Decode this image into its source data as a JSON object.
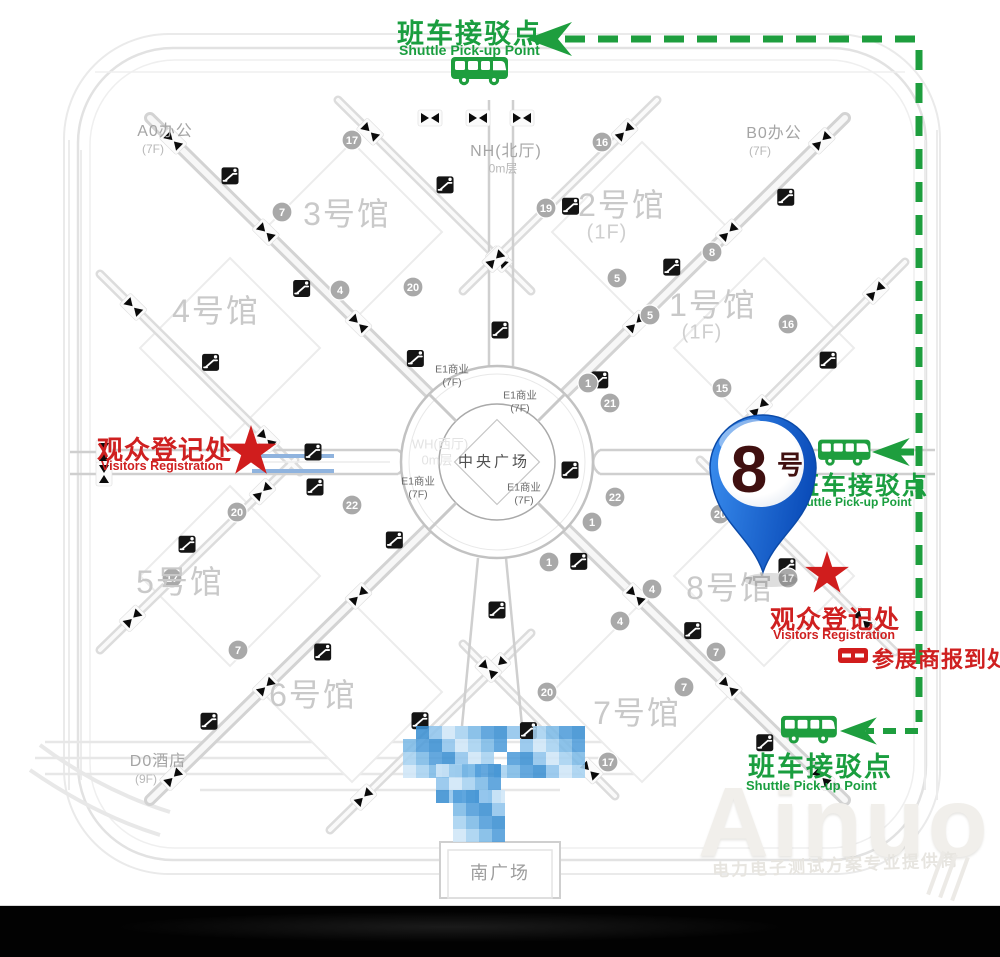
{
  "overlays": {
    "shuttle_top": {
      "cn": "班车接驳点",
      "en": "Shuttle Pick-up Point"
    },
    "shuttle_right": {
      "cn": "班车接驳点",
      "en": "Shuttle Pick-up Point"
    },
    "shuttle_bottom": {
      "cn": "班车接驳点",
      "en": "Shuttle Pick-up Point"
    },
    "visitors_left": {
      "cn": "观众登记处",
      "en": "Visitors Registration"
    },
    "visitors_right": {
      "cn": "观众登记处",
      "en": "Visitors Registration"
    },
    "exhibitor_checkin": {
      "label": "参展商报到处"
    },
    "pin": {
      "number": "8",
      "suffix": "号"
    }
  },
  "map": {
    "halls": [
      {
        "name": "3号馆",
        "floor": ""
      },
      {
        "name": "2号馆",
        "floor": "(1F)"
      },
      {
        "name": "4号馆",
        "floor": ""
      },
      {
        "name": "1号馆",
        "floor": "(1F)"
      },
      {
        "name": "5号馆",
        "floor": ""
      },
      {
        "name": "8号馆",
        "floor": ""
      },
      {
        "name": "6号馆",
        "floor": ""
      },
      {
        "name": "7号馆",
        "floor": ""
      }
    ],
    "buildings": {
      "a0": {
        "name": "A0办公",
        "floor": "(7F)"
      },
      "b0": {
        "name": "B0办公",
        "floor": "(7F)"
      },
      "nh": {
        "name": "NH(北厅)",
        "floor": "0m层"
      },
      "wh": {
        "name": "WH(西厅)",
        "floor": "0m层"
      },
      "d0": {
        "name": "D0酒店",
        "floor": "(9F)"
      }
    },
    "plazas": {
      "center": "中央广场",
      "south": "南广场"
    },
    "retail": {
      "name": "E1商业",
      "floor": "(7F)"
    },
    "gate_badges": [
      {
        "n": "7",
        "x": 282,
        "y": 212
      },
      {
        "n": "20",
        "x": 413,
        "y": 287
      },
      {
        "n": "4",
        "x": 340,
        "y": 290
      },
      {
        "n": "17",
        "x": 352,
        "y": 140
      },
      {
        "n": "16",
        "x": 602,
        "y": 142
      },
      {
        "n": "19",
        "x": 546,
        "y": 208
      },
      {
        "n": "8",
        "x": 712,
        "y": 252
      },
      {
        "n": "5",
        "x": 617,
        "y": 278
      },
      {
        "n": "5",
        "x": 650,
        "y": 315
      },
      {
        "n": "16",
        "x": 788,
        "y": 324
      },
      {
        "n": "15",
        "x": 722,
        "y": 388
      },
      {
        "n": "1",
        "x": 588,
        "y": 383
      },
      {
        "n": "21",
        "x": 610,
        "y": 403
      },
      {
        "n": "22",
        "x": 615,
        "y": 497
      },
      {
        "n": "1",
        "x": 592,
        "y": 522
      },
      {
        "n": "20",
        "x": 237,
        "y": 512
      },
      {
        "n": "22",
        "x": 352,
        "y": 505
      },
      {
        "n": "17",
        "x": 172,
        "y": 578
      },
      {
        "n": "7",
        "x": 238,
        "y": 650
      },
      {
        "n": "20",
        "x": 547,
        "y": 692
      },
      {
        "n": "17",
        "x": 608,
        "y": 762
      },
      {
        "n": "4",
        "x": 652,
        "y": 589
      },
      {
        "n": "4",
        "x": 620,
        "y": 621
      },
      {
        "n": "7",
        "x": 716,
        "y": 652
      },
      {
        "n": "7",
        "x": 684,
        "y": 687
      },
      {
        "n": "1",
        "x": 549,
        "y": 562
      },
      {
        "n": "17",
        "x": 788,
        "y": 578
      },
      {
        "n": "20",
        "x": 720,
        "y": 514
      }
    ]
  },
  "watermark": {
    "brand": "Ainuo",
    "slogan": "电力电子测试方案专业提供商"
  },
  "colors": {
    "route_green": "#1e9e3e",
    "label_red": "#cf2020",
    "pin_blue": "#1565d8",
    "hall_gray": "#c9c9c9"
  }
}
